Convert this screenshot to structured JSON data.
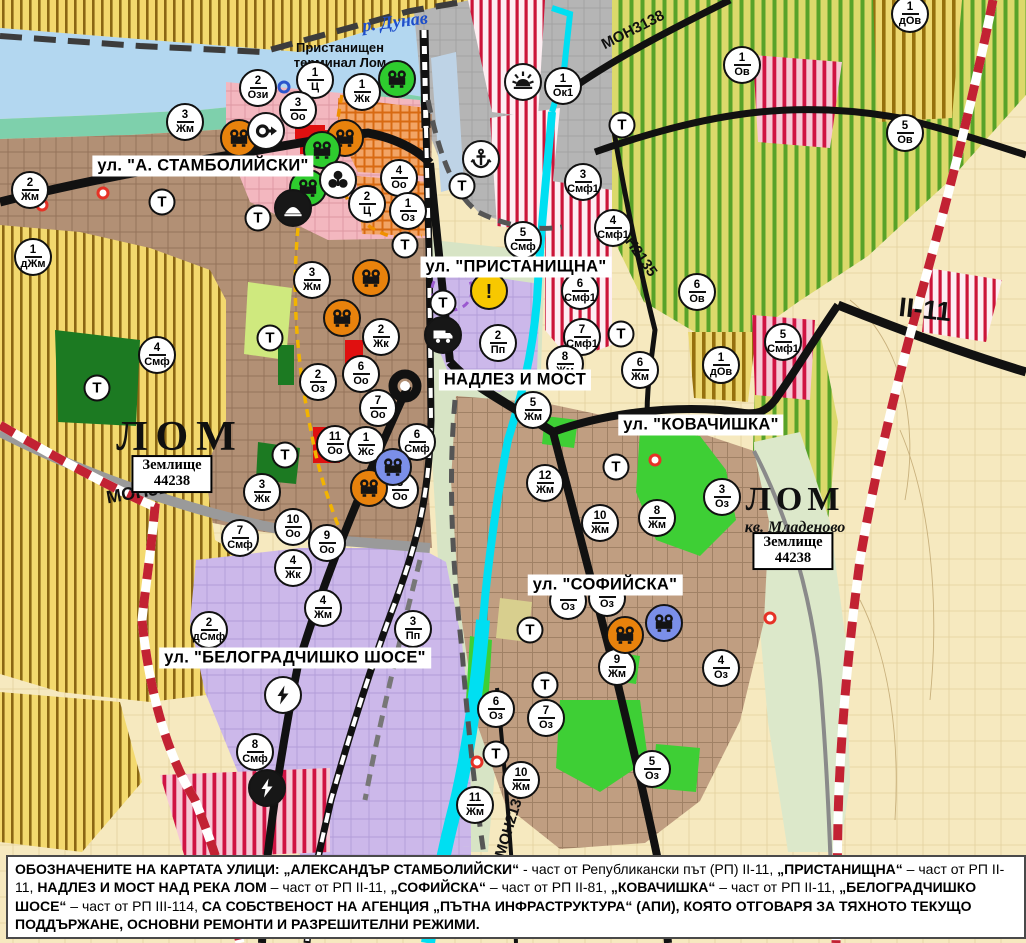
{
  "labels": {
    "streets": [
      {
        "text": "ул. \"А. СТАМБОЛИЙСКИ\"",
        "x": 203,
        "y": 166
      },
      {
        "text": "ул. \"ПРИСТАНИЩНА\"",
        "x": 516,
        "y": 267
      },
      {
        "text": "НАДЛЕЗ И МОСТ",
        "x": 515,
        "y": 380
      },
      {
        "text": "ул. \"КОВАЧИШКА\"",
        "x": 701,
        "y": 425
      },
      {
        "text": "ул. \"СОФИЙСКА\"",
        "x": 605,
        "y": 585
      },
      {
        "text": "ул. \"БЕЛОГРАДЧИШКО ШОСЕ\"",
        "x": 295,
        "y": 658
      }
    ],
    "roads": [
      {
        "text": "МОН3138",
        "x": 633,
        "y": 30,
        "rot": -27,
        "size": 15
      },
      {
        "text": "МОН2135",
        "x": 634,
        "y": 247,
        "rot": 55,
        "size": 15
      },
      {
        "text": "II-11",
        "x": 925,
        "y": 310,
        "rot": 6,
        "size": 27
      },
      {
        "text": "МОН3139",
        "x": 147,
        "y": 491,
        "rot": -10,
        "size": 18
      },
      {
        "text": "МОН2136",
        "x": 510,
        "y": 824,
        "rot": -73,
        "size": 15
      }
    ],
    "cities": [
      {
        "text": "ЛОМ",
        "x": 180,
        "y": 437,
        "size": 42,
        "ls": 8
      },
      {
        "text": "ЛОМ",
        "x": 795,
        "y": 500,
        "size": 34,
        "ls": 5
      }
    ],
    "quarter": {
      "text": "кв. Младеново",
      "x": 795,
      "y": 528
    },
    "river": {
      "text": "р. Дунав",
      "x": 395,
      "y": 22
    },
    "terminal": {
      "line1": "Пристанищен",
      "line2": "терминал Лом",
      "x": 340,
      "y": 56
    },
    "land_boxes": [
      {
        "line1": "Землище",
        "line2": "44238",
        "x": 172,
        "y": 474
      },
      {
        "line1": "Землище",
        "line2": "44238",
        "x": 793,
        "y": 551
      }
    ]
  },
  "markers": {
    "zone": [
      {
        "n": "2",
        "c": "Жм",
        "x": 30,
        "y": 190
      },
      {
        "n": "1",
        "c": "дЖм",
        "x": 33,
        "y": 257
      },
      {
        "n": "3",
        "c": "Жм",
        "x": 185,
        "y": 122
      },
      {
        "n": "2",
        "c": "Ози",
        "x": 258,
        "y": 88
      },
      {
        "n": "1",
        "c": "Ц",
        "x": 315,
        "y": 80
      },
      {
        "n": "3",
        "c": "Оо",
        "x": 298,
        "y": 110
      },
      {
        "n": "1",
        "c": "Жк",
        "x": 362,
        "y": 92
      },
      {
        "n": "4",
        "c": "Оо",
        "x": 399,
        "y": 178
      },
      {
        "n": "2",
        "c": "Ц",
        "x": 367,
        "y": 204
      },
      {
        "n": "1",
        "c": "Оз",
        "x": 408,
        "y": 211
      },
      {
        "n": "1",
        "c": "Ок1",
        "x": 563,
        "y": 86
      },
      {
        "n": "3",
        "c": "Смф1",
        "x": 583,
        "y": 182
      },
      {
        "n": "4",
        "c": "Смф1",
        "x": 613,
        "y": 228
      },
      {
        "n": "5",
        "c": "Смф",
        "x": 523,
        "y": 240
      },
      {
        "n": "6",
        "c": "Смф1",
        "x": 580,
        "y": 291
      },
      {
        "n": "7",
        "c": "Смф1",
        "x": 582,
        "y": 337
      },
      {
        "n": "2",
        "c": "Пп",
        "x": 498,
        "y": 343
      },
      {
        "n": "5",
        "c": "Жм",
        "x": 533,
        "y": 410
      },
      {
        "n": "8",
        "c": "Жм",
        "x": 565,
        "y": 364
      },
      {
        "n": "6",
        "c": "Смф",
        "x": 417,
        "y": 442
      },
      {
        "n": "11",
        "c": "Оо",
        "x": 335,
        "y": 444
      },
      {
        "n": "1",
        "c": "Жс",
        "x": 366,
        "y": 445
      },
      {
        "n": "8",
        "c": "Оо",
        "x": 400,
        "y": 490
      },
      {
        "n": "7",
        "c": "Оо",
        "x": 378,
        "y": 408
      },
      {
        "n": "2",
        "c": "Оз",
        "x": 318,
        "y": 382
      },
      {
        "n": "6",
        "c": "Оо",
        "x": 361,
        "y": 374
      },
      {
        "n": "2",
        "c": "Жк",
        "x": 381,
        "y": 337
      },
      {
        "n": "3",
        "c": "Жм",
        "x": 312,
        "y": 280
      },
      {
        "n": "3",
        "c": "Жк",
        "x": 262,
        "y": 492
      },
      {
        "n": "10",
        "c": "Оо",
        "x": 293,
        "y": 527
      },
      {
        "n": "9",
        "c": "Оо",
        "x": 327,
        "y": 543
      },
      {
        "n": "7",
        "c": "Смф",
        "x": 240,
        "y": 538
      },
      {
        "n": "4",
        "c": "Жк",
        "x": 293,
        "y": 568
      },
      {
        "n": "4",
        "c": "Жм",
        "x": 323,
        "y": 608
      },
      {
        "n": "2",
        "c": "дСмф",
        "x": 209,
        "y": 630
      },
      {
        "n": "3",
        "c": "Пп",
        "x": 413,
        "y": 629
      },
      {
        "n": "8",
        "c": "Смф",
        "x": 255,
        "y": 752
      },
      {
        "n": "4",
        "c": "Смф",
        "x": 157,
        "y": 355
      },
      {
        "n": "12",
        "c": "Жм",
        "x": 545,
        "y": 483
      },
      {
        "n": "10",
        "c": "Жм",
        "x": 600,
        "y": 523
      },
      {
        "n": "8",
        "c": "Жм",
        "x": 657,
        "y": 518
      },
      {
        "n": "3",
        "c": "Оз",
        "x": 722,
        "y": 497
      },
      {
        "n": "6",
        "c": "Жм",
        "x": 640,
        "y": 370
      },
      {
        "n": "6",
        "c": "Ов",
        "x": 697,
        "y": 292
      },
      {
        "n": "1",
        "c": "дОв",
        "x": 721,
        "y": 365
      },
      {
        "n": "5",
        "c": "Смф1",
        "x": 783,
        "y": 342
      },
      {
        "n": "1",
        "c": "Ов",
        "x": 742,
        "y": 65
      },
      {
        "n": "5",
        "c": "Ов",
        "x": 905,
        "y": 133
      },
      {
        "n": "1",
        "c": "дОв",
        "x": 910,
        "y": 14
      },
      {
        "n": "9",
        "c": "Жм",
        "x": 617,
        "y": 667
      },
      {
        "n": "4",
        "c": "Оз",
        "x": 721,
        "y": 668
      },
      {
        "n": "6",
        "c": "Оз",
        "x": 496,
        "y": 709
      },
      {
        "n": "7",
        "c": "Оз",
        "x": 546,
        "y": 718
      },
      {
        "n": "10",
        "c": "Жм",
        "x": 521,
        "y": 780
      },
      {
        "n": "11",
        "c": "Жм",
        "x": 475,
        "y": 805
      },
      {
        "n": "5",
        "c": "Оз",
        "x": 652,
        "y": 769
      },
      {
        "n": "",
        "c": "Оз",
        "x": 568,
        "y": 601
      },
      {
        "n": "",
        "c": "Оз",
        "x": 607,
        "y": 598
      }
    ],
    "t": {
      "label": "Т",
      "points": [
        [
          162,
          202
        ],
        [
          258,
          218
        ],
        [
          270,
          338
        ],
        [
          97,
          388
        ],
        [
          285,
          455
        ],
        [
          405,
          245
        ],
        [
          462,
          186
        ],
        [
          443,
          303
        ],
        [
          622,
          125
        ],
        [
          621,
          334
        ],
        [
          616,
          467
        ],
        [
          530,
          630
        ],
        [
          545,
          685
        ],
        [
          496,
          754
        ]
      ]
    },
    "icons": [
      {
        "icon": "monument-icon",
        "color": "orange",
        "x": 239,
        "y": 138
      },
      {
        "icon": "monument-icon",
        "color": "orange",
        "x": 345,
        "y": 138
      },
      {
        "icon": "monument-icon",
        "color": "green",
        "x": 397,
        "y": 79
      },
      {
        "icon": "monument-icon",
        "color": "green",
        "x": 322,
        "y": 150
      },
      {
        "icon": "monument-icon",
        "color": "green",
        "x": 308,
        "y": 188
      },
      {
        "icon": "monument-icon",
        "color": "orange",
        "x": 371,
        "y": 278
      },
      {
        "icon": "monument-icon",
        "color": "orange",
        "x": 342,
        "y": 318
      },
      {
        "icon": "monument-icon",
        "color": "orange",
        "x": 369,
        "y": 488
      },
      {
        "icon": "monument-icon",
        "color": "blue",
        "x": 393,
        "y": 467
      },
      {
        "icon": "monument-icon",
        "color": "orange",
        "x": 625,
        "y": 635
      },
      {
        "icon": "monument-icon",
        "color": "blue",
        "x": 664,
        "y": 623
      },
      {
        "icon": "arrow-right-icon",
        "color": "white",
        "x": 266,
        "y": 131
      },
      {
        "icon": "trefoil-icon",
        "color": "white",
        "x": 338,
        "y": 180
      },
      {
        "icon": "mound-icon",
        "color": "dark",
        "x": 293,
        "y": 208
      },
      {
        "icon": "sun-icon",
        "color": "white",
        "x": 523,
        "y": 82
      },
      {
        "icon": "anchor-icon",
        "color": "white",
        "x": 481,
        "y": 159
      },
      {
        "icon": "warning-icon",
        "color": "yellow",
        "x": 489,
        "y": 291
      },
      {
        "icon": "truck-icon",
        "color": "dark",
        "x": 443,
        "y": 335
      },
      {
        "icon": "lightning-icon",
        "color": "white",
        "x": 283,
        "y": 695
      },
      {
        "icon": "lightning-icon",
        "color": "dark",
        "x": 267,
        "y": 788
      }
    ],
    "dots": {
      "red": [
        [
          42,
          205
        ],
        [
          103,
          193
        ],
        [
          655,
          460
        ],
        [
          477,
          762
        ],
        [
          770,
          618
        ]
      ],
      "blue": [
        [
          284,
          87
        ]
      ]
    }
  },
  "note": {
    "segments": [
      {
        "t": "ОБОЗНАЧЕНИТЕ НА КАРТАТА УЛИЦИ: ",
        "b": 1
      },
      {
        "t": "„АЛЕКСАНДЪР СТАМБОЛИЙСКИ“",
        "b": 1
      },
      {
        "t": " - част от Републикански път (РП) II-11, ",
        "b": 0
      },
      {
        "t": "„ПРИСТАНИЩНА“",
        "b": 1
      },
      {
        "t": " – част от РП II-11, ",
        "b": 0
      },
      {
        "t": "НАДЛЕЗ И МОСТ НАД РЕКА ЛОМ",
        "b": 1
      },
      {
        "t": " – част от РП II-11, ",
        "b": 0
      },
      {
        "t": "„СОФИЙСКА“",
        "b": 1
      },
      {
        "t": " – част от РП II-81, ",
        "b": 0
      },
      {
        "t": "„КОВАЧИШКА“",
        "b": 1
      },
      {
        "t": " – част от РП II-11, ",
        "b": 0
      },
      {
        "t": "„БЕЛОГРАДЧИШКО ШОСЕ“",
        "b": 1
      },
      {
        "t": " – част от РП III-114, ",
        "b": 0
      },
      {
        "t": "СА СОБСТВЕНОСТ НА АГЕНЦИЯ „ПЪТНА ИНФРАСТРУКТУРА“ (АПИ), КОЯТО ОТГОВАРЯ ЗА ТЯХНОТО ТЕКУЩО ПОДДЪРЖАНЕ, ОСНОВНИ РЕМОНТИ И РАЗРЕШИТЕЛНИ РЕЖИМИ.",
        "b": 1
      }
    ]
  },
  "colors": {
    "water": "#b3d7f0",
    "river_cyan": "#00dff2",
    "shore_green": "#7ed0ac",
    "road_black": "#111111",
    "boundary_red": "#c22233",
    "marker_orange": "#e8820c",
    "marker_green": "#2ecc2e",
    "marker_blue": "#7b8fe8",
    "warning_yellow": "#f7c800",
    "urban_brown": "#b29075",
    "industry_purple": "#ccb8ea",
    "agri_yellow": "#f3d96e"
  }
}
